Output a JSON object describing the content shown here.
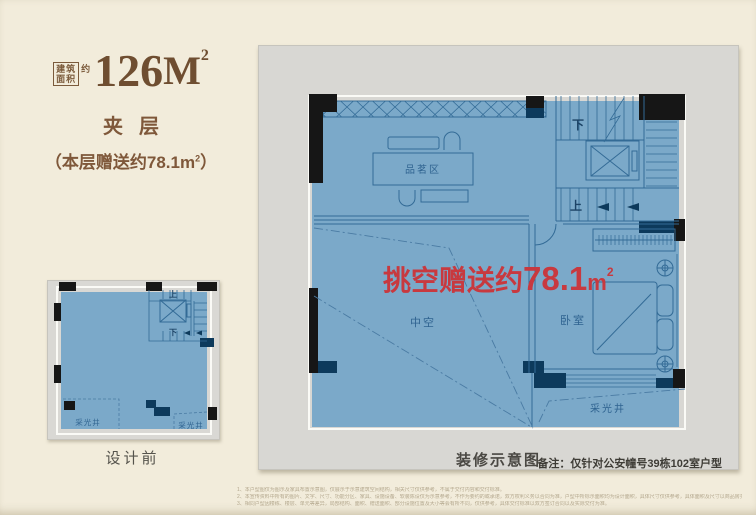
{
  "header": {
    "badge": {
      "top": "建筑",
      "bottom": "面积",
      "approx": "约"
    },
    "area": {
      "value": "126",
      "unit": "M",
      "sup": "2"
    },
    "floor_label": "夹层",
    "bonus": {
      "prefix": "（本层赠送约",
      "value": "78.1",
      "unit": "m",
      "sup": "2",
      "suffix": "）"
    }
  },
  "before_plan": {
    "caption": "设计前",
    "up": "上",
    "down": "下",
    "lightwell_left": "采光井",
    "lightwell_right": "采光井"
  },
  "after_plan": {
    "caption": "装修示意图",
    "note": "备注：仅针对公安幢号39栋102室户型",
    "rooms": {
      "tea": "品茗区",
      "void": "中空",
      "bedroom": "卧室",
      "lightwell": "采光井"
    },
    "up": "上",
    "down": "下",
    "highlight": {
      "prefix": "挑空赠送约",
      "value": "78.1",
      "unit": "m",
      "sup": "2"
    }
  },
  "colors": {
    "floor_blue": "#7ba9c9",
    "line_blue": "#336b96",
    "wall_black": "#161616",
    "wall_navy": "#0d3a5c",
    "accent_red": "#c8393f",
    "text_brown": "#7f583a",
    "panel_gray": "#d8d7d3",
    "page_cream": "#f2ecdb"
  },
  "disclaimer": {
    "lines": [
      "1、本户型图仅为图示及家具布置示意图，仅展示于示意建筑空间结构，相关尺寸仅供参考，不属于交付内容和交付标准。",
      "2、本宣传资料中所有的图片、文字、尺寸、功能分区、家具、设施设备、软装陈设仅为示意参考，不作为要约的或承诺，双方权利义务以合同为准，户型中所标示面积均为设计面积，具体尺寸仅供参考，具体面积及尺寸以商品房买卖合同及双方签订的书面合同文件为准。",
      "3、相同户型因楼栋、楼层、单元等差异，局部结构、面积、赠送面积、部分设施位置及大小等会有所不同，仅供参考，具体交付标准以双方签订合同以及实际交付为准。"
    ]
  }
}
